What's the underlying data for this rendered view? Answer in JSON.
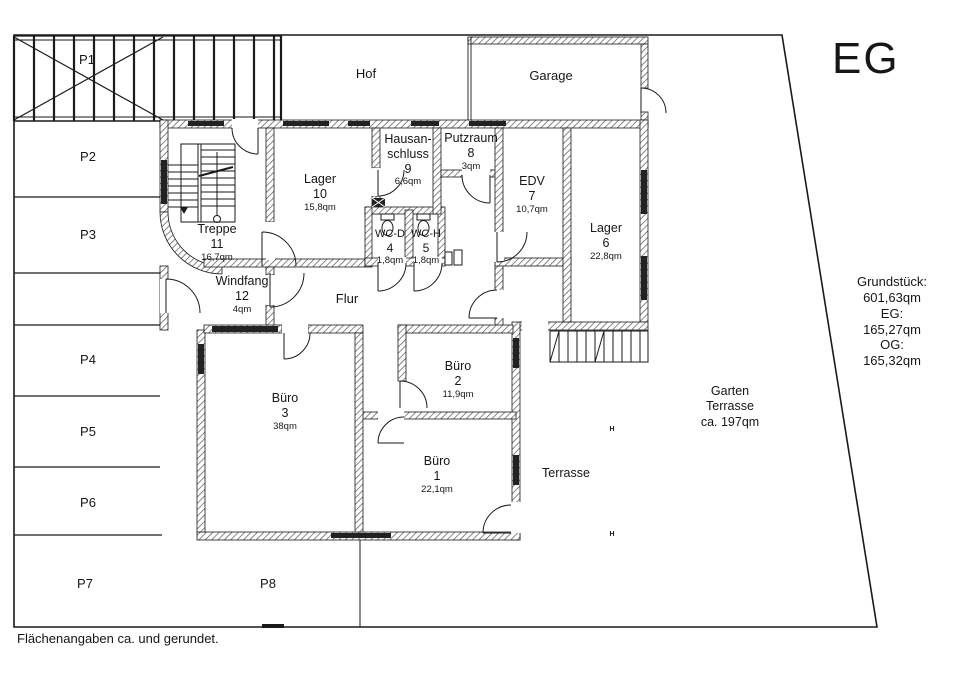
{
  "title": "EG",
  "plan": {
    "site": {
      "hof": "Hof",
      "garage": "Garage",
      "terrasse": "Terrasse",
      "garten": [
        "Garten",
        "Terrasse",
        "ca. 197qm"
      ],
      "hydrant": "H"
    },
    "parking": {
      "p1": "P1",
      "p2": "P2",
      "p3": "P3",
      "p4": "P4",
      "p5": "P5",
      "p6": "P6",
      "p7": "P7",
      "p8": "P8"
    },
    "rooms": {
      "buero1": {
        "name": "Büro",
        "number": "1",
        "area": "22,1qm"
      },
      "buero2": {
        "name": "Büro",
        "number": "2",
        "area": "11,9qm"
      },
      "buero3": {
        "name": "Büro",
        "number": "3",
        "area": "38qm"
      },
      "wc_d": {
        "name": "WC-D",
        "number": "4",
        "area": "1,8qm"
      },
      "wc_h": {
        "name": "WC-H",
        "number": "5",
        "area": "1,8qm"
      },
      "lager6": {
        "name": "Lager",
        "number": "6",
        "area": "22,8qm"
      },
      "edv": {
        "name": "EDV",
        "number": "7",
        "area": "10,7qm"
      },
      "putzraum": {
        "name": "Putzraum",
        "number": "8",
        "area": "3qm"
      },
      "hausanschluss": {
        "name": "Hausan-",
        "name2": "schluss",
        "number": "9",
        "area": "6,6qm"
      },
      "lager10": {
        "name": "Lager",
        "number": "10",
        "area": "15,8qm"
      },
      "treppe": {
        "name": "Treppe",
        "number": "11",
        "area": "16,7qm"
      },
      "windfang": {
        "name": "Windfang",
        "number": "12",
        "area": "4qm"
      },
      "flur": {
        "name": "Flur"
      }
    },
    "areas_summary": [
      "Grundstück: 601,63qm",
      "EG: 165,27qm",
      "OG: 165,32qm"
    ],
    "footnote": "Flächenangaben ca. und gerundet."
  },
  "symbols": {
    "stairs": "stairs-symbol",
    "toilet": "toilet-symbol",
    "door": "door-swing-symbol",
    "shaft": "shaft-symbol",
    "carport": "carport-symbol"
  },
  "colors": {
    "background": "#ffffff",
    "line": "#1a1a1a",
    "wall_hatch": "#555555",
    "window_sill": "#222222",
    "text": "#161616"
  }
}
